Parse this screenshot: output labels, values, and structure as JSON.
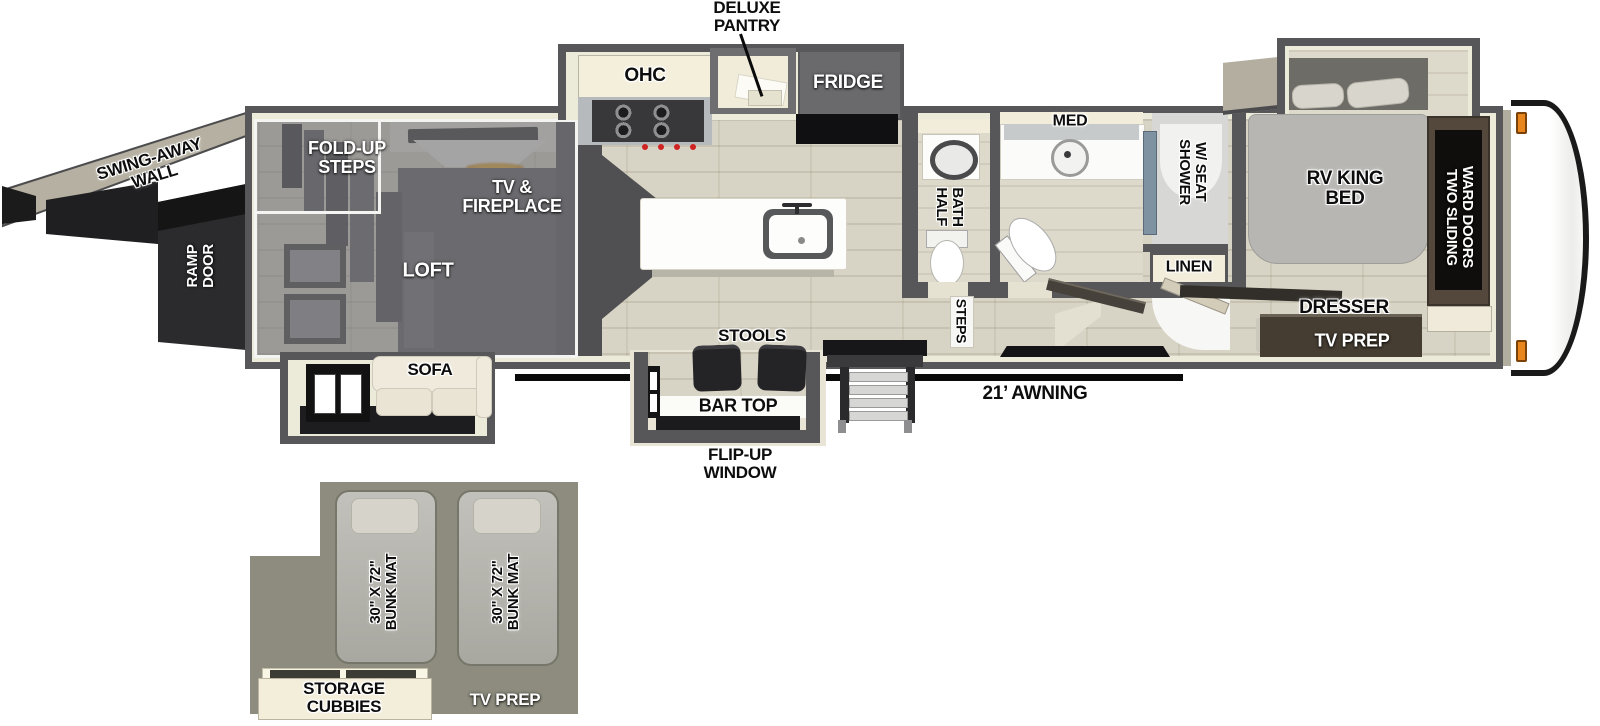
{
  "palette": {
    "wall_gray": "#57575a",
    "floor_tan": "#d8d4c5",
    "cabinet_cream": "#f2edda",
    "dark_wood": "#4a4136",
    "appliance_gray": "#6a6a6d",
    "loft_overlay_gray": "#787a7c",
    "bunk_area_olive": "#8d8c7e",
    "awning_black": "#0a0a0a",
    "marker_light_orange": "#e8851c",
    "fireplace_glow_amber": "#d9961f"
  },
  "callouts": {
    "deluxe_pantry": "DELUXE\nPANTRY",
    "swing_away_wall": "SWING-AWAY\nWALL",
    "ramp_door": "RAMP\nDOOR",
    "awning": "21’ AWNING",
    "flip_up_window": "FLIP-UP\nWINDOW"
  },
  "garage": {
    "fold_up_steps": "FOLD-UP\nSTEPS",
    "tv_fireplace": "TV &\nFIREPLACE",
    "loft": "LOFT",
    "sofa": "SOFA"
  },
  "kitchen": {
    "ohc": "OHC",
    "fridge": "FRIDGE",
    "stools": "STOOLS",
    "bar_top": "BAR TOP"
  },
  "bath": {
    "half_bath": "HALF\nBATH",
    "med": "MED",
    "shower_w_seat": "SHOWER\nW/ SEAT",
    "linen": "LINEN",
    "steps": "STEPS"
  },
  "bedroom": {
    "rv_king_bed": "RV KING\nBED",
    "two_sliding_ward_doors": "TWO SLIDING\nWARD DOORS",
    "dresser": "DRESSER",
    "tv_prep": "TV PREP"
  },
  "loft_inset": {
    "bunk_mat_left": "30\" X 72\"\nBUNK MAT",
    "bunk_mat_right": "30\" X 72\"\nBUNK MAT",
    "storage_cubbies": "STORAGE\nCUBBIES",
    "tv_prep": "TV PREP"
  }
}
